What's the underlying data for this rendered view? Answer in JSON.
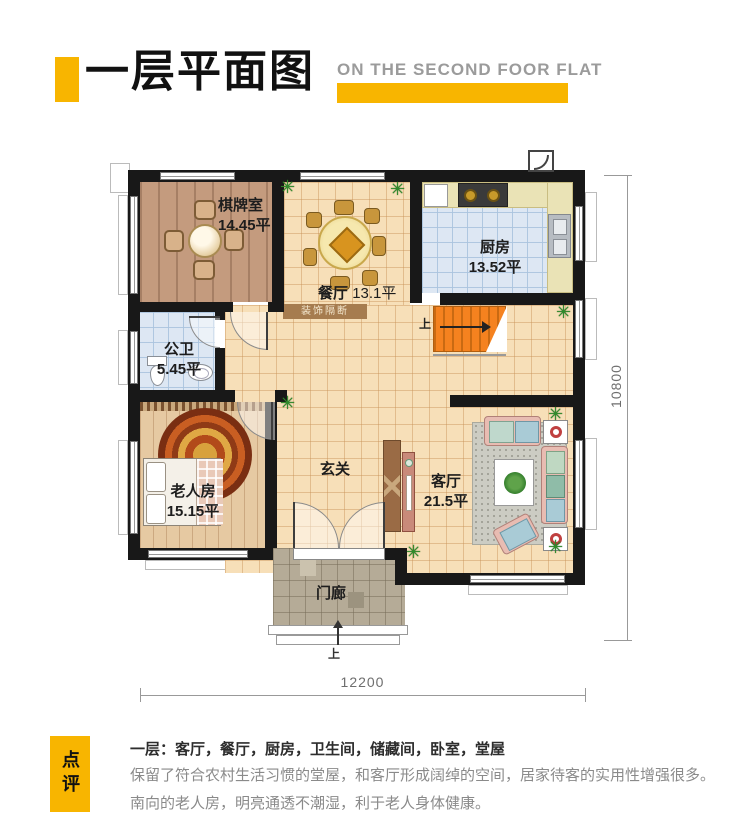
{
  "header": {
    "title": "一层平面图",
    "subtitle": "ON THE SECOND FOOR FLAT"
  },
  "plan": {
    "rooms": {
      "chess": {
        "name": "棋牌室",
        "area": "14.45平"
      },
      "dining": {
        "name": "餐厅",
        "area": "13.1平"
      },
      "kitchen": {
        "name": "厨房",
        "area": "13.52平"
      },
      "bathroom": {
        "name": "公卫",
        "area": "5.45平"
      },
      "elder": {
        "name": "老人房",
        "area": "15.15平"
      },
      "foyer": {
        "name": "玄关"
      },
      "living": {
        "name": "客厅",
        "area": "21.5平"
      },
      "porch": {
        "name": "门廊"
      }
    },
    "partition_label": "装饰隔断",
    "stairs_up_label": "上",
    "entrance_up_label": "上",
    "dimensions": {
      "bottom": "12200",
      "right": "10800"
    }
  },
  "review": {
    "badge": "点评",
    "line1": "一层：客厅，餐厅，厨房，卫生间，储藏间，卧室，堂屋",
    "line2": "保留了符合农村生活习惯的堂屋，和客厅形成阔绰的空间，居家待客的实用性增强很多。南向的老人房，明亮通透不潮湿，利于老人身体健康。"
  },
  "icons": {
    "plant": "✳"
  },
  "colors": {
    "accent": "#F8B500",
    "wall": "#181818",
    "stairs": "#F5821F"
  }
}
